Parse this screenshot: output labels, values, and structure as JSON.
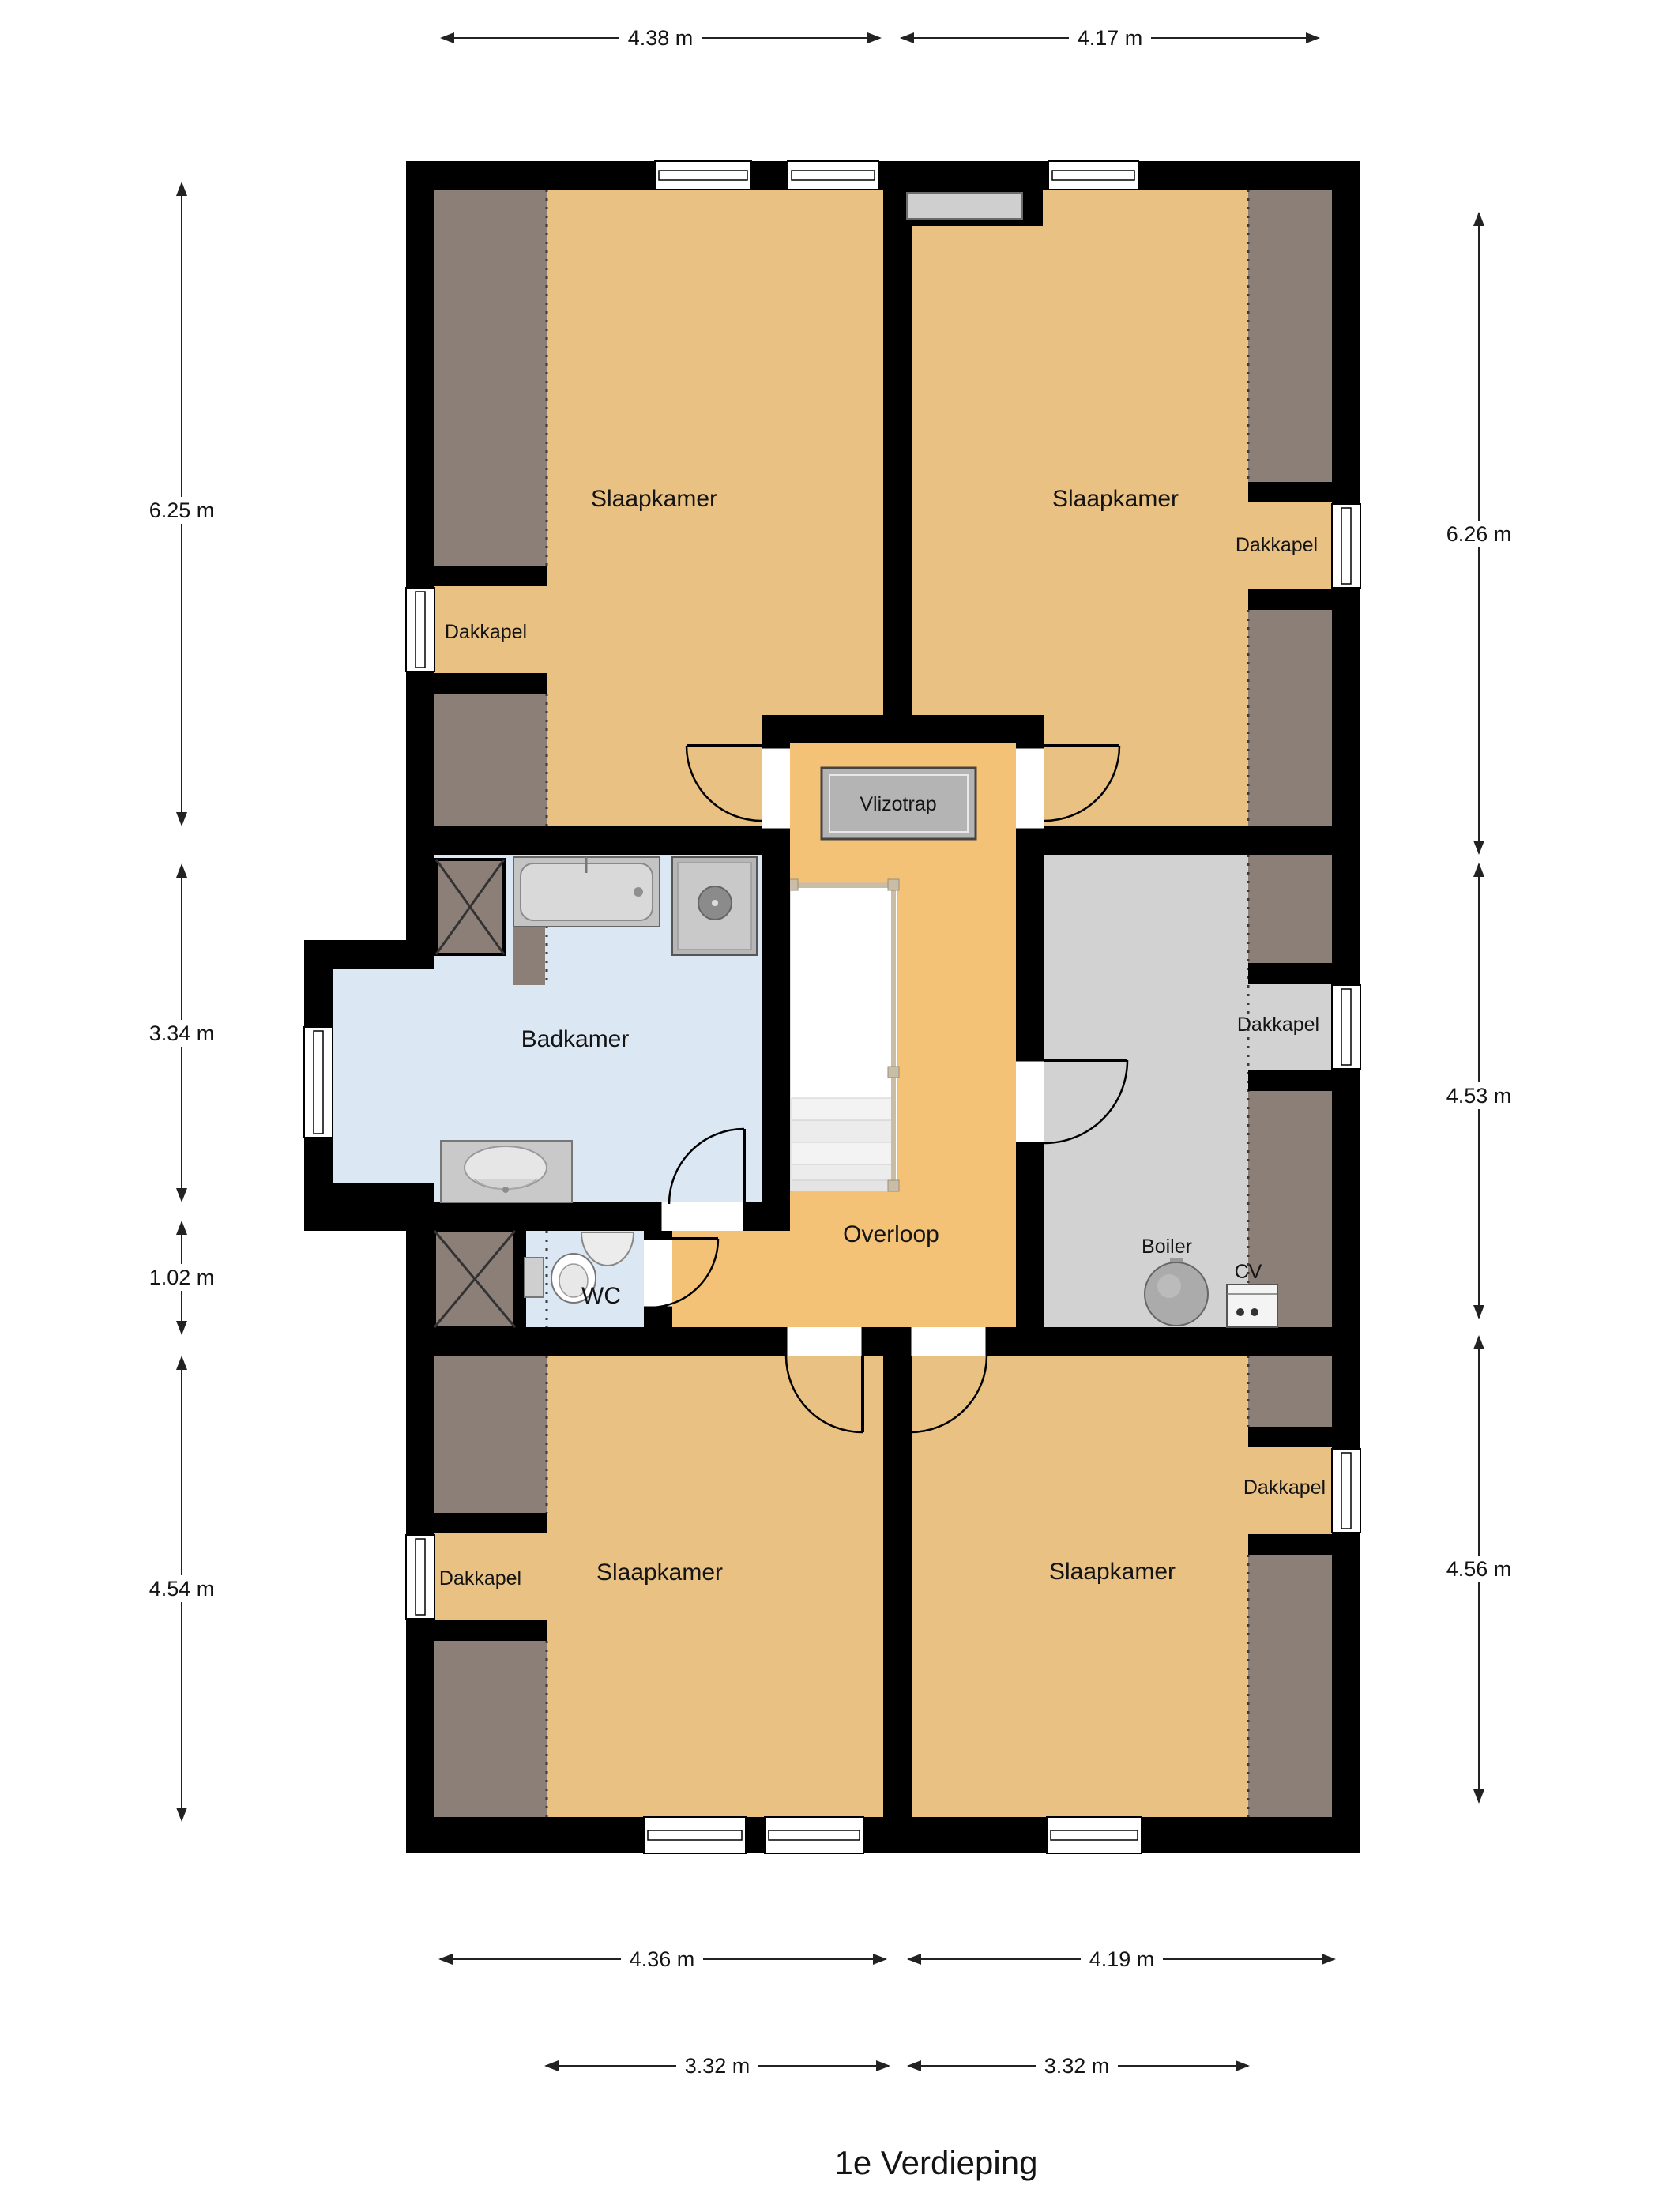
{
  "title": "1e Verdieping",
  "plan": {
    "rooms": [
      {
        "id": "slaapkamer-top-left",
        "label": "Slaapkamer"
      },
      {
        "id": "slaapkamer-top-right",
        "label": "Slaapkamer"
      },
      {
        "id": "badkamer",
        "label": "Badkamer"
      },
      {
        "id": "wc",
        "label": "WC"
      },
      {
        "id": "overloop",
        "label": "Overloop"
      },
      {
        "id": "slaapkamer-bottom-left",
        "label": "Slaapkamer"
      },
      {
        "id": "slaapkamer-bottom-right",
        "label": "Slaapkamer"
      }
    ],
    "features": {
      "vlizotrap": "Vlizotrap",
      "boiler": "Boiler",
      "cv": "CV",
      "dakkapels": [
        "Dakkapel",
        "Dakkapel",
        "Dakkapel",
        "Dakkapel",
        "Dakkapel"
      ]
    },
    "dimensions": {
      "top": [
        "4.38 m",
        "4.17 m"
      ],
      "left": [
        "6.25 m",
        "3.34 m",
        "1.02 m",
        "4.54 m"
      ],
      "right": [
        "6.26 m",
        "4.53 m",
        "4.56 m"
      ],
      "bottom_outer": [
        "4.36 m",
        "4.19 m"
      ],
      "bottom_inner": [
        "3.32 m",
        "3.32 m"
      ]
    },
    "colors": {
      "wall": "#000000",
      "bedroom_floor": "#e9c183",
      "hall_floor": "#f3c276",
      "bathroom_floor": "#dbe8f4",
      "storage_floor": "#d2d2d2",
      "sloped_ceiling": "#8c7f78",
      "hatch_gray": "#b4b4b4",
      "railing": "#c9bda6"
    }
  }
}
